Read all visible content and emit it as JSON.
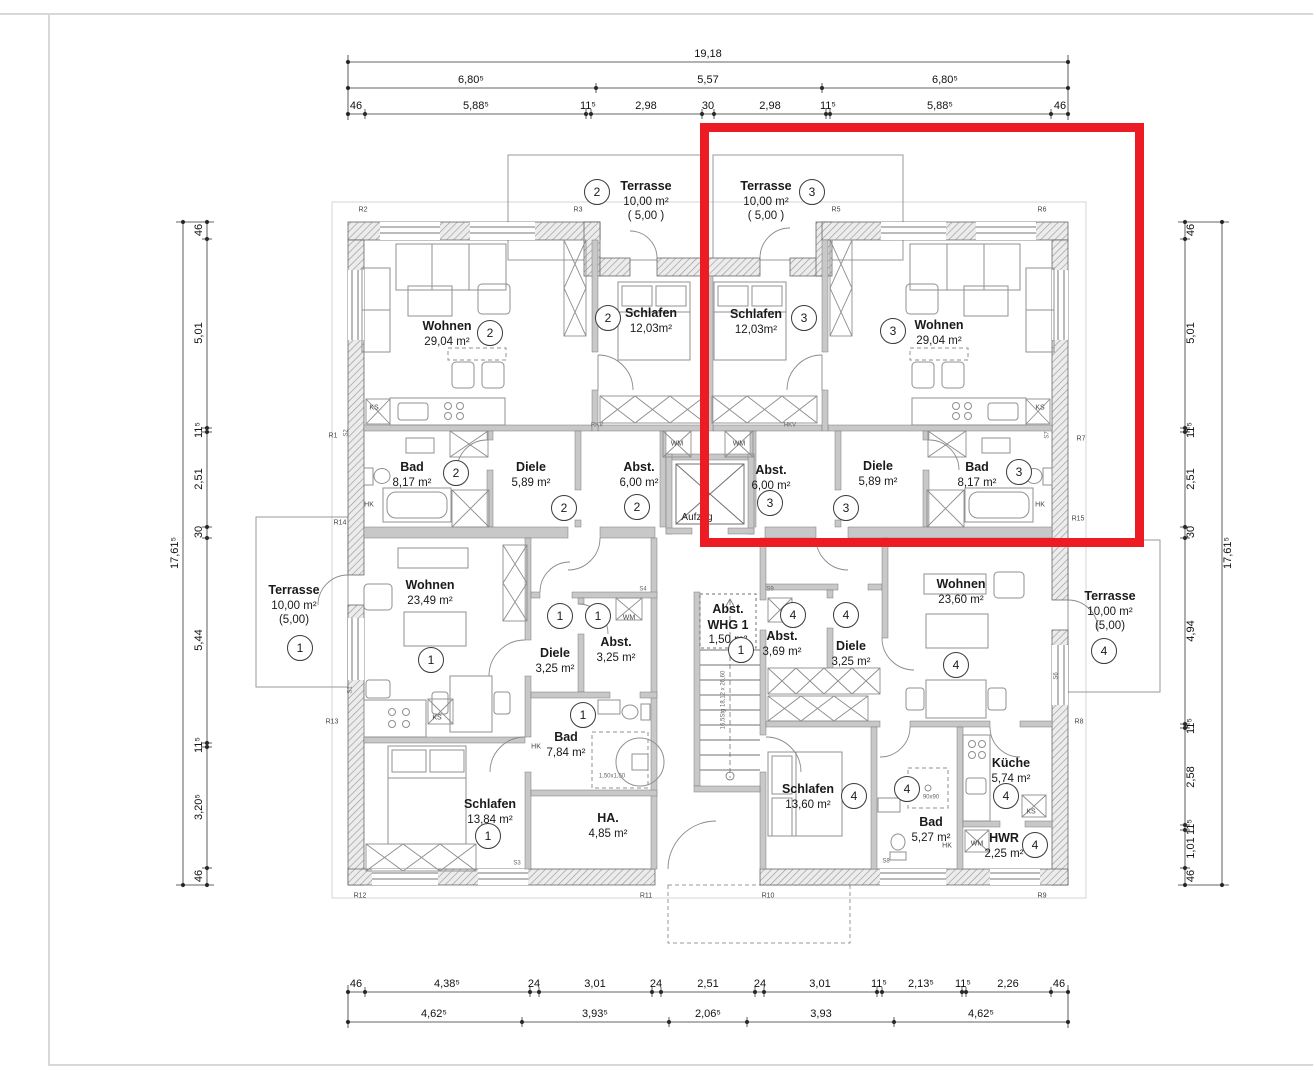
{
  "colors": {
    "highlight": "#ed1c24",
    "walls": "#9a9a9a",
    "dimension_text": "#111111",
    "furniture": "#909090",
    "page_frame": "#d8d8d8"
  },
  "highlight_box": {
    "x": 700,
    "y": 123,
    "w": 444,
    "h": 424
  },
  "rooms": [
    {
      "id": "terrasse-2",
      "name": "Terrasse",
      "area": "10,00 m²",
      "sub": "( 5,00 )",
      "x": 646,
      "y": 201
    },
    {
      "id": "terrasse-3",
      "name": "Terrasse",
      "area": "10,00 m²",
      "sub": "( 5,00 )",
      "x": 766,
      "y": 201
    },
    {
      "id": "wohnen-2",
      "name": "Wohnen",
      "area": "29,04 m²",
      "sub": "",
      "x": 447,
      "y": 334
    },
    {
      "id": "schlafen-2",
      "name": "Schlafen",
      "area": "12,03m²",
      "sub": "",
      "x": 651,
      "y": 321
    },
    {
      "id": "schlafen-3",
      "name": "Schlafen",
      "area": "12,03m²",
      "sub": "",
      "x": 756,
      "y": 322
    },
    {
      "id": "wohnen-3",
      "name": "Wohnen",
      "area": "29,04 m²",
      "sub": "",
      "x": 939,
      "y": 333
    },
    {
      "id": "bad-2",
      "name": "Bad",
      "area": "8,17 m²",
      "sub": "",
      "x": 412,
      "y": 475
    },
    {
      "id": "diele-2",
      "name": "Diele",
      "area": "5,89 m²",
      "sub": "",
      "x": 531,
      "y": 475
    },
    {
      "id": "abst-2",
      "name": "Abst.",
      "area": "6,00 m²",
      "sub": "",
      "x": 639,
      "y": 475
    },
    {
      "id": "abst-3",
      "name": "Abst.",
      "area": "6,00 m²",
      "sub": "",
      "x": 771,
      "y": 478
    },
    {
      "id": "diele-3",
      "name": "Diele",
      "area": "5,89 m²",
      "sub": "",
      "x": 878,
      "y": 474
    },
    {
      "id": "bad-3",
      "name": "Bad",
      "area": "8,17 m²",
      "sub": "",
      "x": 977,
      "y": 475
    },
    {
      "id": "terrasse-1",
      "name": "Terrasse",
      "area": "10,00 m²",
      "sub": "(5,00)",
      "x": 294,
      "y": 605
    },
    {
      "id": "terrasse-4",
      "name": "Terrasse",
      "area": "10,00 m²",
      "sub": "(5,00)",
      "x": 1110,
      "y": 611
    },
    {
      "id": "wohnen-1",
      "name": "Wohnen",
      "area": "23,49 m²",
      "sub": "",
      "x": 430,
      "y": 593
    },
    {
      "id": "diele-1",
      "name": "Diele",
      "area": "3,25 m²",
      "sub": "",
      "x": 555,
      "y": 661
    },
    {
      "id": "abst-1",
      "name": "Abst.",
      "area": "3,25 m²",
      "sub": "",
      "x": 616,
      "y": 650
    },
    {
      "id": "bad-1",
      "name": "Bad",
      "area": "7,84 m²",
      "sub": "",
      "x": 566,
      "y": 745
    },
    {
      "id": "schlafen-1",
      "name": "Schlafen",
      "area": "13,84 m²",
      "sub": "",
      "x": 490,
      "y": 812
    },
    {
      "id": "ha-1",
      "name": "HA.",
      "area": "4,85 m²",
      "sub": "",
      "x": 608,
      "y": 826
    },
    {
      "id": "abst-whg1",
      "name": "Abst.\nWHG 1",
      "area": "1,50 m²",
      "sub": "",
      "x": 728,
      "y": 625
    },
    {
      "id": "abst-4",
      "name": "Abst.",
      "area": "3,69 m²",
      "sub": "",
      "x": 782,
      "y": 644
    },
    {
      "id": "diele-4",
      "name": "Diele",
      "area": "3,25 m²",
      "sub": "",
      "x": 851,
      "y": 654
    },
    {
      "id": "wohnen-4",
      "name": "Wohnen",
      "area": "23,60 m²",
      "sub": "",
      "x": 961,
      "y": 592
    },
    {
      "id": "schlafen-4",
      "name": "Schlafen",
      "area": "13,60 m²",
      "sub": "",
      "x": 808,
      "y": 797
    },
    {
      "id": "bad-4",
      "name": "Bad",
      "area": "5,27 m²",
      "sub": "",
      "x": 931,
      "y": 830
    },
    {
      "id": "kueche-4",
      "name": "Küche",
      "area": "5,74 m²",
      "sub": "",
      "x": 1011,
      "y": 771
    },
    {
      "id": "hwr-4",
      "name": "HWR",
      "area": "2,25 m²",
      "sub": "",
      "x": 1004,
      "y": 846
    }
  ],
  "unit_circles": [
    {
      "n": "2",
      "x": 597,
      "y": 192
    },
    {
      "n": "3",
      "x": 812,
      "y": 192
    },
    {
      "n": "2",
      "x": 490,
      "y": 333
    },
    {
      "n": "2",
      "x": 608,
      "y": 318
    },
    {
      "n": "3",
      "x": 804,
      "y": 318
    },
    {
      "n": "3",
      "x": 893,
      "y": 331
    },
    {
      "n": "2",
      "x": 456,
      "y": 473
    },
    {
      "n": "2",
      "x": 564,
      "y": 508
    },
    {
      "n": "2",
      "x": 637,
      "y": 507
    },
    {
      "n": "3",
      "x": 770,
      "y": 503
    },
    {
      "n": "3",
      "x": 846,
      "y": 508
    },
    {
      "n": "3",
      "x": 1019,
      "y": 472
    },
    {
      "n": "1",
      "x": 300,
      "y": 648
    },
    {
      "n": "1",
      "x": 431,
      "y": 660
    },
    {
      "n": "1",
      "x": 560,
      "y": 616
    },
    {
      "n": "1",
      "x": 598,
      "y": 616
    },
    {
      "n": "1",
      "x": 583,
      "y": 715
    },
    {
      "n": "1",
      "x": 488,
      "y": 836
    },
    {
      "n": "1",
      "x": 741,
      "y": 650
    },
    {
      "n": "4",
      "x": 793,
      "y": 615
    },
    {
      "n": "4",
      "x": 846,
      "y": 615
    },
    {
      "n": "4",
      "x": 956,
      "y": 665
    },
    {
      "n": "4",
      "x": 854,
      "y": 796
    },
    {
      "n": "4",
      "x": 907,
      "y": 789
    },
    {
      "n": "4",
      "x": 1006,
      "y": 796
    },
    {
      "n": "4",
      "x": 1035,
      "y": 845
    },
    {
      "n": "4",
      "x": 1104,
      "y": 651
    }
  ],
  "dim_labels_h": [
    {
      "t": "19,18",
      "x": 708,
      "y": 55
    },
    {
      "t": "6,80⁵",
      "x": 471,
      "y": 81
    },
    {
      "t": "5,57",
      "x": 708,
      "y": 81
    },
    {
      "t": "6,80⁵",
      "x": 945,
      "y": 81
    },
    {
      "t": "46",
      "x": 356,
      "y": 107
    },
    {
      "t": "5,88⁵",
      "x": 476,
      "y": 107
    },
    {
      "t": "11⁵",
      "x": 588,
      "y": 107
    },
    {
      "t": "2,98",
      "x": 646,
      "y": 107
    },
    {
      "t": "30",
      "x": 708,
      "y": 107
    },
    {
      "t": "2,98",
      "x": 770,
      "y": 107
    },
    {
      "t": "11⁵",
      "x": 828,
      "y": 107
    },
    {
      "t": "5,88⁵",
      "x": 940,
      "y": 107
    },
    {
      "t": "46",
      "x": 1060,
      "y": 107
    },
    {
      "t": "46",
      "x": 356,
      "y": 985
    },
    {
      "t": "4,38⁵",
      "x": 447,
      "y": 985
    },
    {
      "t": "24",
      "x": 534,
      "y": 985
    },
    {
      "t": "3,01",
      "x": 595,
      "y": 985
    },
    {
      "t": "24",
      "x": 656,
      "y": 985
    },
    {
      "t": "2,51",
      "x": 708,
      "y": 985
    },
    {
      "t": "24",
      "x": 760,
      "y": 985
    },
    {
      "t": "3,01",
      "x": 820,
      "y": 985
    },
    {
      "t": "11⁵",
      "x": 879,
      "y": 985
    },
    {
      "t": "2,13⁵",
      "x": 921,
      "y": 985
    },
    {
      "t": "11⁵",
      "x": 963,
      "y": 985
    },
    {
      "t": "2,26",
      "x": 1008,
      "y": 985
    },
    {
      "t": "46",
      "x": 1059,
      "y": 985
    },
    {
      "t": "4,62⁵",
      "x": 434,
      "y": 1015
    },
    {
      "t": "3,93⁵",
      "x": 595,
      "y": 1015
    },
    {
      "t": "2,06⁵",
      "x": 708,
      "y": 1015
    },
    {
      "t": "3,93",
      "x": 821,
      "y": 1015
    },
    {
      "t": "4,62⁵",
      "x": 981,
      "y": 1015
    }
  ],
  "dim_labels_v": [
    {
      "t": "17,61⁵",
      "x": 176,
      "y": 553
    },
    {
      "t": "46",
      "x": 200,
      "y": 230
    },
    {
      "t": "5,01",
      "x": 200,
      "y": 333
    },
    {
      "t": "11⁵",
      "x": 200,
      "y": 430
    },
    {
      "t": "2,51",
      "x": 200,
      "y": 479
    },
    {
      "t": "30",
      "x": 200,
      "y": 532
    },
    {
      "t": "5,44",
      "x": 200,
      "y": 640
    },
    {
      "t": "11⁵",
      "x": 200,
      "y": 745
    },
    {
      "t": "3,20⁵",
      "x": 200,
      "y": 807
    },
    {
      "t": "46",
      "x": 200,
      "y": 876
    },
    {
      "t": "46",
      "x": 1192,
      "y": 230
    },
    {
      "t": "5,01",
      "x": 1192,
      "y": 333
    },
    {
      "t": "11⁵",
      "x": 1192,
      "y": 430
    },
    {
      "t": "2,51",
      "x": 1192,
      "y": 479
    },
    {
      "t": "30",
      "x": 1192,
      "y": 532
    },
    {
      "t": "4,94",
      "x": 1192,
      "y": 631
    },
    {
      "t": "11⁵",
      "x": 1192,
      "y": 726
    },
    {
      "t": "2,58",
      "x": 1192,
      "y": 777
    },
    {
      "t": "11⁵",
      "x": 1192,
      "y": 827
    },
    {
      "t": "1,01",
      "x": 1192,
      "y": 848
    },
    {
      "t": "46",
      "x": 1192,
      "y": 876
    },
    {
      "t": "17,61⁵",
      "x": 1229,
      "y": 553
    }
  ],
  "small_labels": [
    {
      "t": "Aufzug",
      "x": 697,
      "y": 518,
      "s": "t10"
    },
    {
      "t": "R1",
      "x": 333,
      "y": 437
    },
    {
      "t": "R2",
      "x": 363,
      "y": 211
    },
    {
      "t": "R3",
      "x": 578,
      "y": 211
    },
    {
      "t": "R5",
      "x": 836,
      "y": 211
    },
    {
      "t": "R6",
      "x": 1042,
      "y": 211
    },
    {
      "t": "R7",
      "x": 1081,
      "y": 440
    },
    {
      "t": "R8",
      "x": 1079,
      "y": 723
    },
    {
      "t": "R9",
      "x": 1042,
      "y": 897
    },
    {
      "t": "R10",
      "x": 768,
      "y": 897
    },
    {
      "t": "R11",
      "x": 646,
      "y": 897
    },
    {
      "t": "R12",
      "x": 360,
      "y": 897
    },
    {
      "t": "R13",
      "x": 332,
      "y": 723
    },
    {
      "t": "R14",
      "x": 340,
      "y": 524
    },
    {
      "t": "R15",
      "x": 1078,
      "y": 520
    },
    {
      "t": "KS",
      "x": 374,
      "y": 409
    },
    {
      "t": "KS",
      "x": 1040,
      "y": 409
    },
    {
      "t": "KS",
      "x": 437,
      "y": 719
    },
    {
      "t": "KS",
      "x": 1031,
      "y": 813
    },
    {
      "t": "HK",
      "x": 369,
      "y": 506
    },
    {
      "t": "HK",
      "x": 1040,
      "y": 506
    },
    {
      "t": "HK",
      "x": 536,
      "y": 748
    },
    {
      "t": "HK",
      "x": 947,
      "y": 847
    },
    {
      "t": "WM",
      "x": 677,
      "y": 445
    },
    {
      "t": "WM",
      "x": 739,
      "y": 445
    },
    {
      "t": "WM",
      "x": 629,
      "y": 619
    },
    {
      "t": "WM",
      "x": 977,
      "y": 845
    },
    {
      "t": "RKV",
      "x": 597,
      "y": 426,
      "s": "t6"
    },
    {
      "t": "HKV",
      "x": 790,
      "y": 426,
      "s": "t6"
    },
    {
      "t": "1,50x1,50",
      "x": 612,
      "y": 777,
      "s": "t6"
    },
    {
      "t": "90x90",
      "x": 931,
      "y": 798,
      "s": "t6"
    },
    {
      "t": "16,5Stg 18,12 x 26,60",
      "x": 724,
      "y": 700,
      "s": "t6",
      "rot": true
    },
    {
      "t": "S1",
      "x": 351,
      "y": 690,
      "rot": true,
      "s": "t6"
    },
    {
      "t": "S2",
      "x": 347,
      "y": 433,
      "rot": true,
      "s": "t6"
    },
    {
      "t": "S3",
      "x": 517,
      "y": 864,
      "s": "t6"
    },
    {
      "t": "S4",
      "x": 643,
      "y": 590,
      "s": "t6"
    },
    {
      "t": "S9",
      "x": 770,
      "y": 590,
      "s": "t6"
    },
    {
      "t": "S7",
      "x": 1048,
      "y": 435,
      "rot": true,
      "s": "t6"
    },
    {
      "t": "S6",
      "x": 1057,
      "y": 676,
      "rot": true,
      "s": "t6"
    },
    {
      "t": "S8",
      "x": 886,
      "y": 862,
      "s": "t6"
    }
  ]
}
